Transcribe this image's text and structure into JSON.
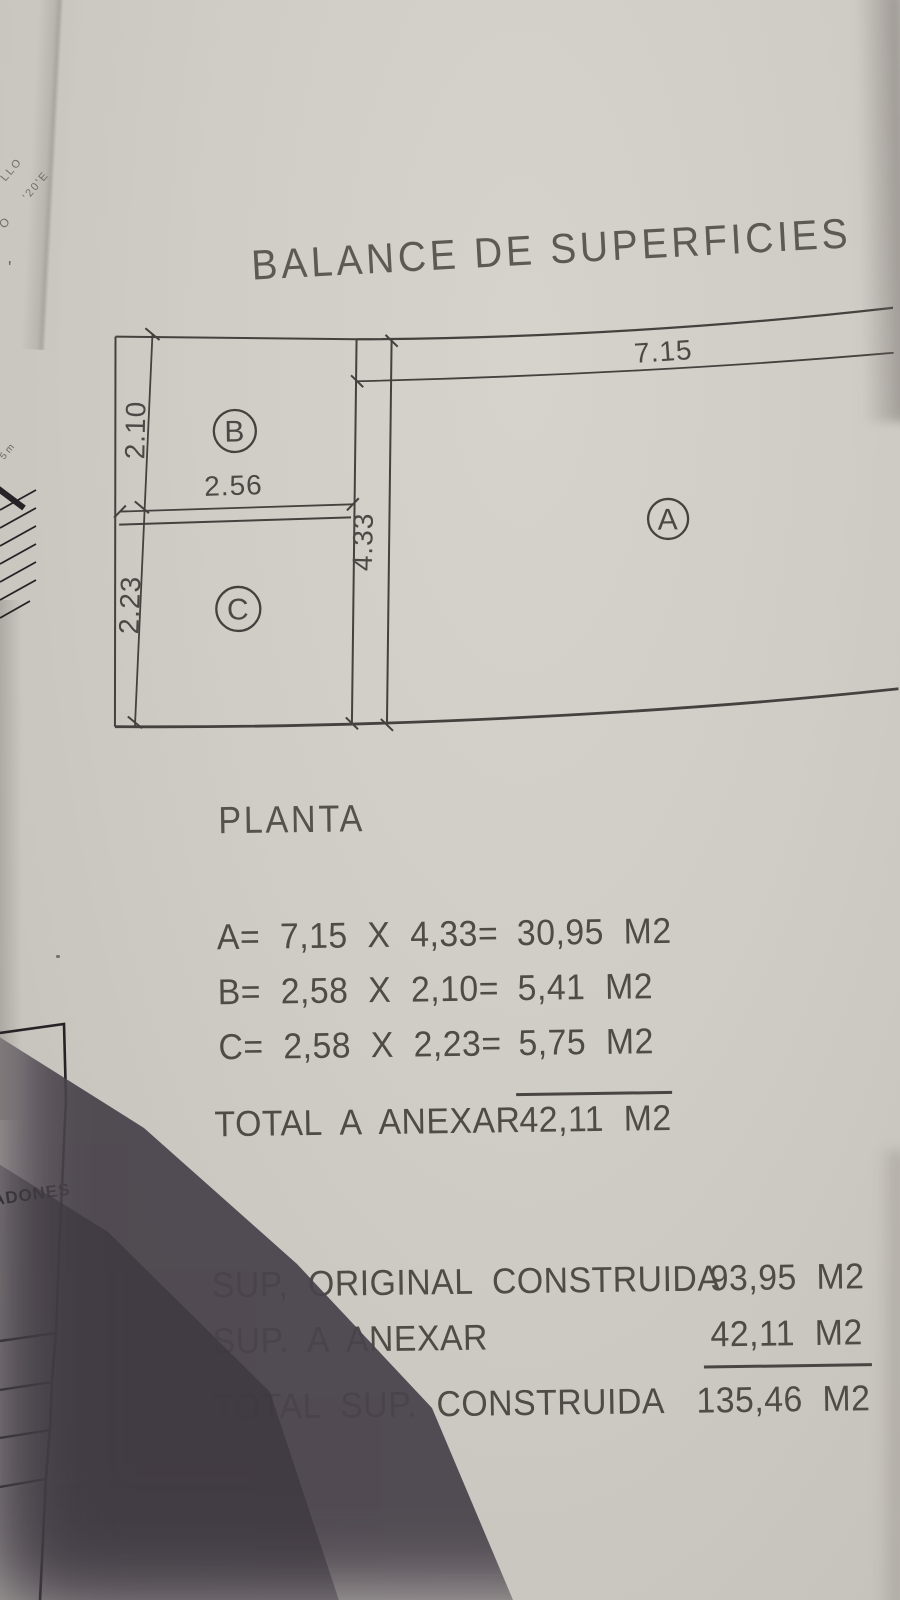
{
  "title": "BALANCE DE SUPERFICIES",
  "plan": {
    "heading": "PLANTA",
    "rooms": [
      {
        "id": "A"
      },
      {
        "id": "B"
      },
      {
        "id": "C"
      }
    ],
    "dimensions": {
      "width_a": "7.15",
      "height_a": "4.33",
      "width_bc": "2.56",
      "height_b": "2.10",
      "height_c": "2.23"
    }
  },
  "calc": {
    "rows": [
      {
        "formula": "A=  7,15  X  4,33=",
        "result": "30,95  M2"
      },
      {
        "formula": "B=  2,58  X  2,10=",
        "result": "5,41  M2"
      },
      {
        "formula": "C=  2,58  X  2,23=",
        "result": "5,75  M2"
      }
    ],
    "total_label": "TOTAL  A  ANEXAR",
    "total_value": "42,11  M2"
  },
  "summary": {
    "rows": [
      {
        "label": "SUP,  ORIGINAL  CONSTRUIDA",
        "value": "93,95  M2"
      },
      {
        "label": "SUP.  A  ANEXAR",
        "value": "42,11  M2"
      },
      {
        "label": "TOTAL  SUP.  CONSTRUIDA",
        "value": "135,46  M2"
      }
    ]
  },
  "margin": {
    "stamp_line1": "LLO",
    "stamp_line2": "'20'E",
    "stamp_mark": "O",
    "apostrophe": "'",
    "hatch_label": "5 m",
    "edge_text": "ADONES"
  }
}
